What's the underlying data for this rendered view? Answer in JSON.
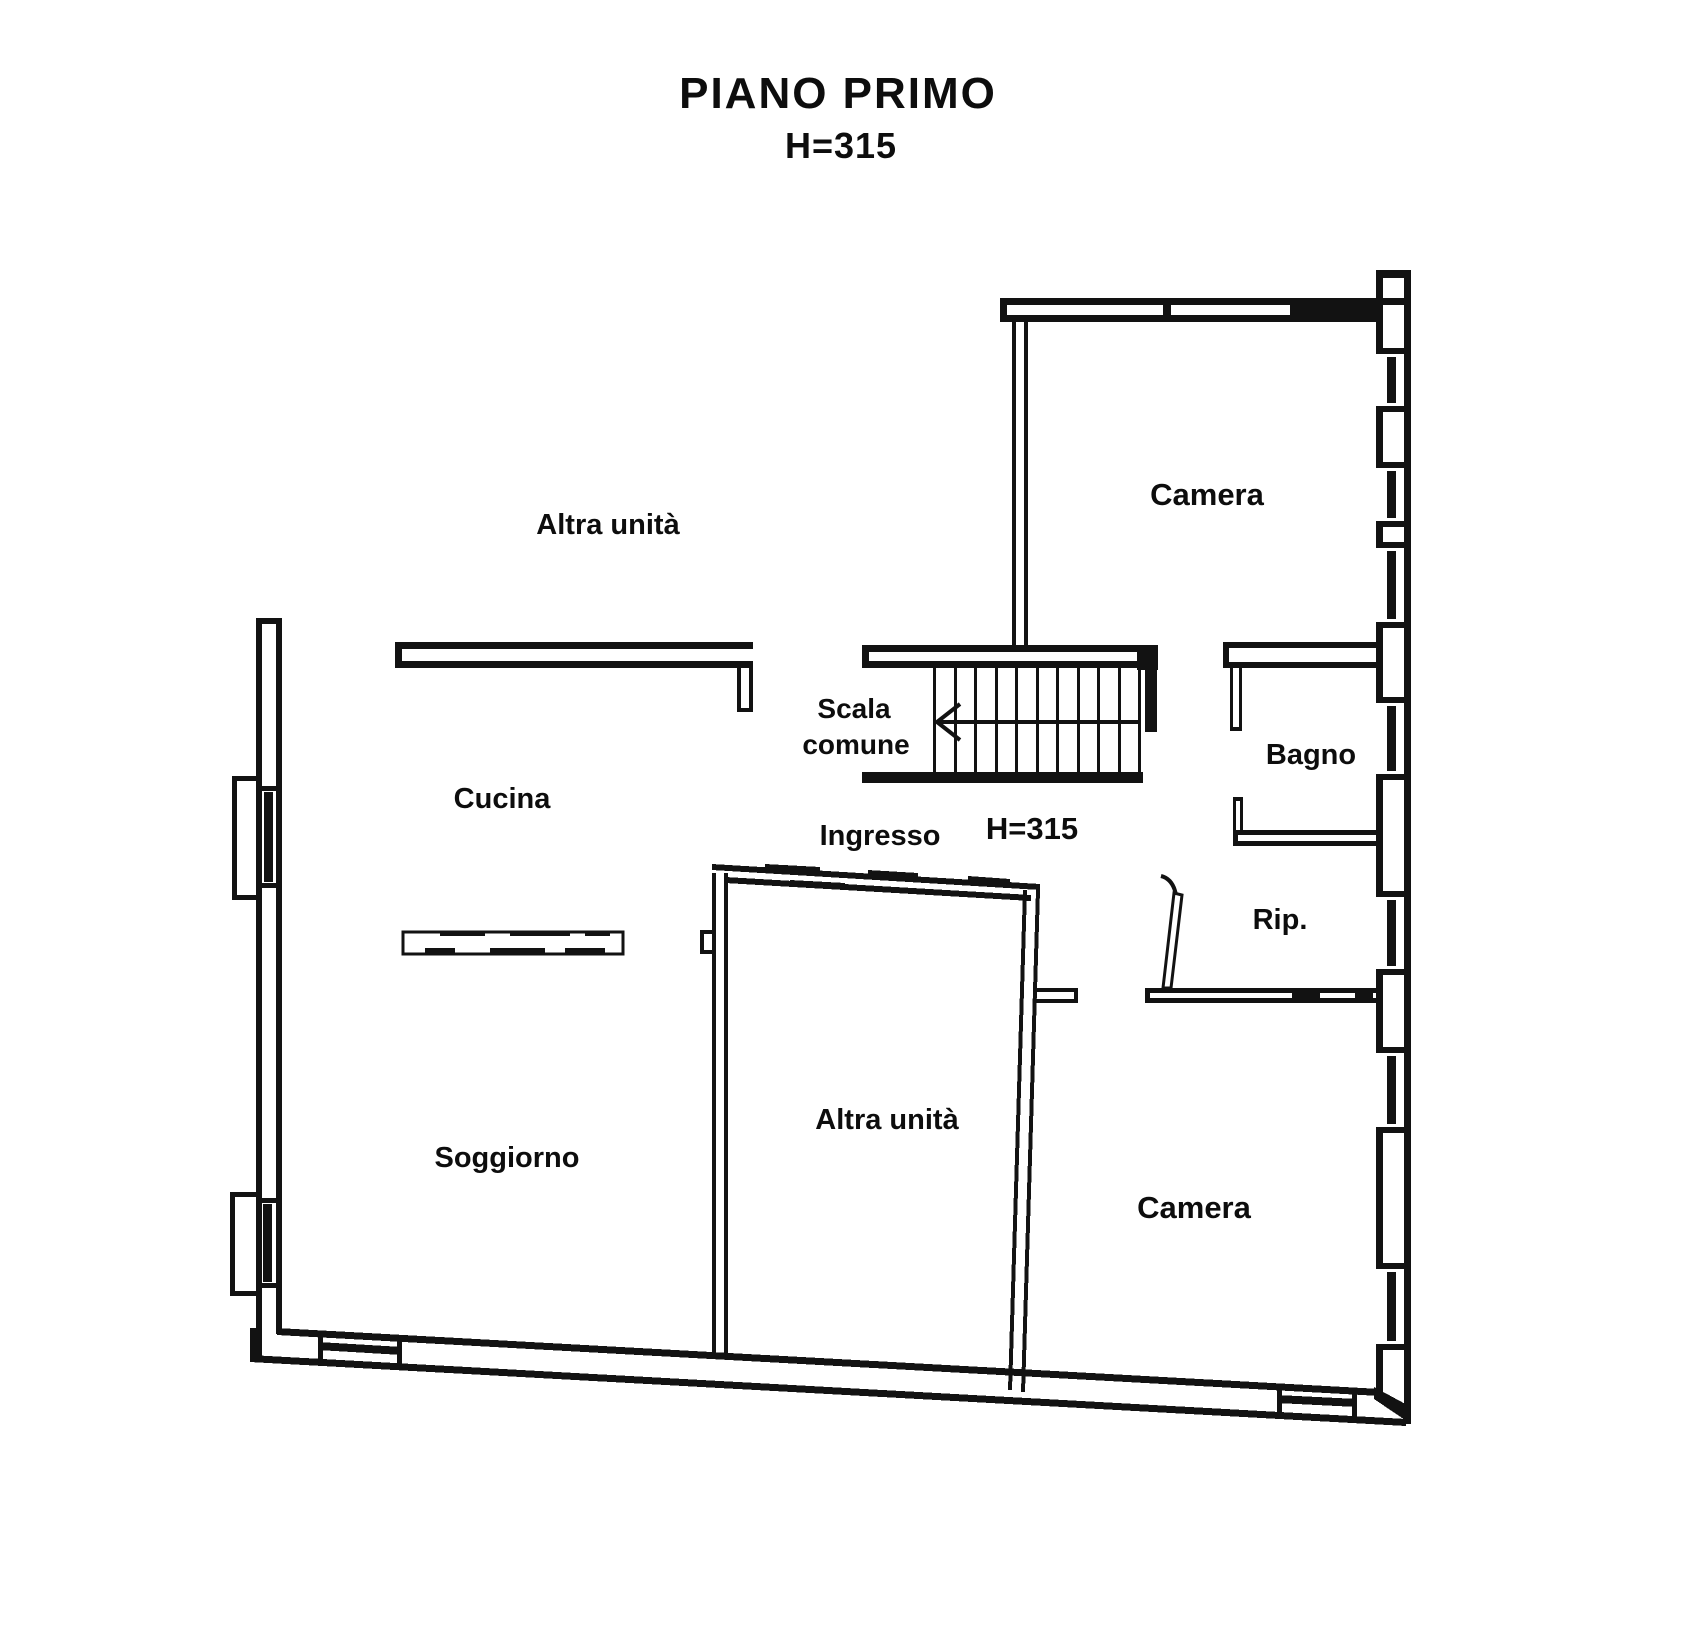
{
  "header": {
    "title": "PIANO PRIMO",
    "subtitle": "H=315"
  },
  "plan": {
    "labels": {
      "altra_unita_top": "Altra unità",
      "camera_top": "Camera",
      "cucina": "Cucina",
      "scala_comune_line1": "Scala",
      "scala_comune_line2": "comune",
      "ingresso": "Ingresso",
      "room_height": "H=315",
      "bagno": "Bagno",
      "rip": "Rip.",
      "soggiorno": "Soggiorno",
      "altra_unita_center": "Altra unità",
      "camera_bottom": "Camera"
    },
    "colors": {
      "wall": "#121212",
      "text": "#0d0d0d",
      "background": "#ffffff"
    }
  }
}
